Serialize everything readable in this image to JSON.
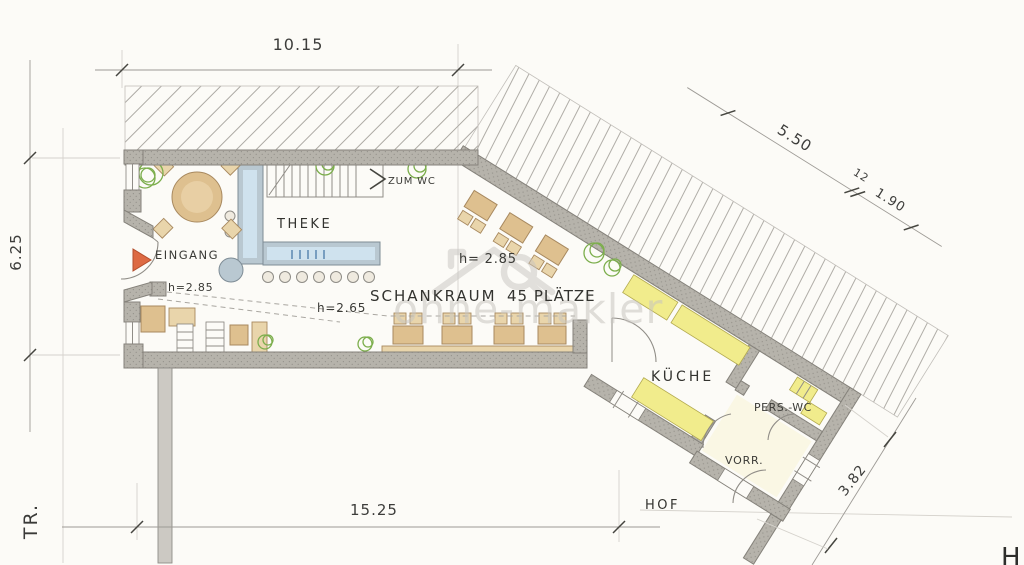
{
  "watermark": {
    "text": "ohne-makler"
  },
  "rooms": {
    "eingang": {
      "label": "EINGANG",
      "height": "h=2.85"
    },
    "theke": {
      "label": "THEKE"
    },
    "schankraum": {
      "label": "SCHANKRAUM",
      "seats": "45 PLÄTZE",
      "height_left": "h=2.65",
      "height_right": "h= 2.85"
    },
    "zum_wc": {
      "label": "ZUM WC"
    },
    "kueche": {
      "label": "KÜCHE"
    },
    "pers_wc": {
      "label": "PERS.-WC"
    },
    "vorrat": {
      "label": "VORR."
    },
    "hof": {
      "label": "HOF"
    }
  },
  "dimensions": {
    "top": "10.15",
    "left": "6.25",
    "bottom": "15.25",
    "diag_upper": "5.50",
    "diag_chain_mark": "12",
    "diag_lower": "1.90",
    "right_lower": "3.82"
  },
  "street_label": "TR.",
  "corner_letter": "H",
  "colors": {
    "paper": "#fcfbf7",
    "pencil": "#908d87",
    "ink": "#35352f",
    "wood": "#dec08f",
    "woodlt": "#e9d5ab",
    "wood-dk": "#a8895f",
    "accent": "#dd6a43",
    "yellow": "#f1ec8c",
    "green": "#7cae4c",
    "cblue": "#cfe2ee",
    "cgray": "#b9c8d1",
    "wm": "#c8c5c0"
  }
}
